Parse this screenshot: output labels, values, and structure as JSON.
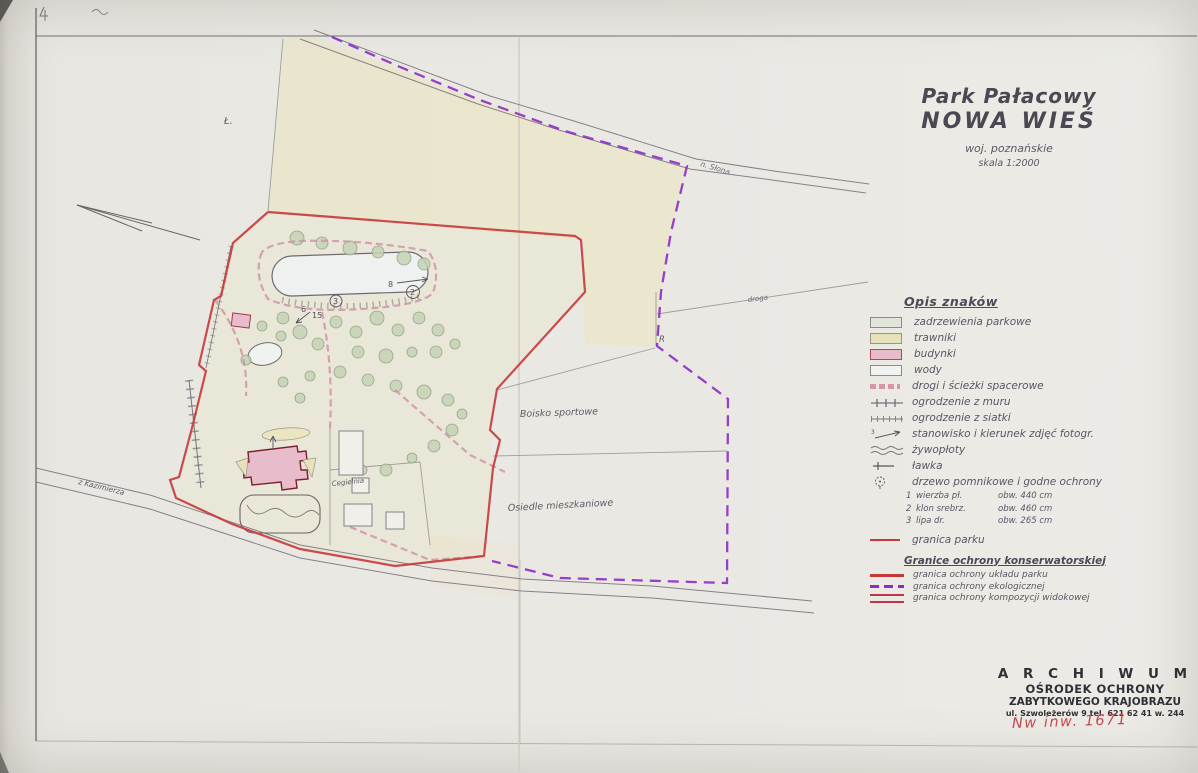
{
  "title": {
    "line1": "Park Pałacowy",
    "line2": "NOWA WIEŚ",
    "region": "woj. poznańskie",
    "scale": "skala 1:2000"
  },
  "map_labels": {
    "road_top": "n. Słona",
    "road_bottom": "z Kazimierza",
    "road_right": "droga",
    "sports_field": "Boisko sportowe",
    "housing": "Osiedle mieszkaniowe",
    "brickworks": "Cegielnia",
    "field_mark": "R",
    "meadow_mark": "Ł.",
    "tree_numbers": [
      "15",
      "2",
      "3",
      "6",
      "8"
    ]
  },
  "legend": {
    "header": "Opis znaków",
    "photo_sample_no": "3",
    "items": [
      {
        "label": "zadrzewienia parkowe"
      },
      {
        "label": "trawniki"
      },
      {
        "label": "budynki"
      },
      {
        "label": "wody"
      },
      {
        "label": "drogi i ścieżki spacerowe"
      },
      {
        "label": "ogrodzenie z muru"
      },
      {
        "label": "ogrodzenie z siatki"
      },
      {
        "label": "stanowisko i kierunek zdjęć fotogr."
      },
      {
        "label": "żywopłoty"
      },
      {
        "label": "ławka"
      },
      {
        "label": "drzewo pomnikowe i godne ochrony"
      }
    ],
    "trees": [
      {
        "no": "1",
        "name": "wierzba pł.",
        "girth": "obw. 440 cm"
      },
      {
        "no": "2",
        "name": "klon srebrz.",
        "girth": "obw. 460 cm"
      },
      {
        "no": "3",
        "name": "lipa dr.",
        "girth": "obw. 265 cm"
      }
    ],
    "park_boundary_label": "granica parku",
    "section2": {
      "header": "Granice ochrony konserwatorskiej",
      "items": [
        {
          "label": "granica ochrony układu parku"
        },
        {
          "label": "granica ochrony ekologicznej"
        },
        {
          "label": "granica ochrony kompozycji widokowej"
        }
      ]
    }
  },
  "stamp": {
    "line1": "A R C H I W U M",
    "line2": "OŚRODEK OCHRONY",
    "line3": "ZABYTKOWEGO KRAJOBRAZU",
    "line4": "ul. Szwoleżerów 9  tel. 621 62 41 w. 244",
    "inventory_no": "Nw inw. 1671"
  },
  "colors": {
    "park_boundary": "#c5393b",
    "eco_boundary": "#8c2cc6",
    "building_fill": "#e9bccb",
    "lawn_fill": "#e5e2ba",
    "aged_paper": "#ebe3bd",
    "paper": "#eae8e3"
  }
}
